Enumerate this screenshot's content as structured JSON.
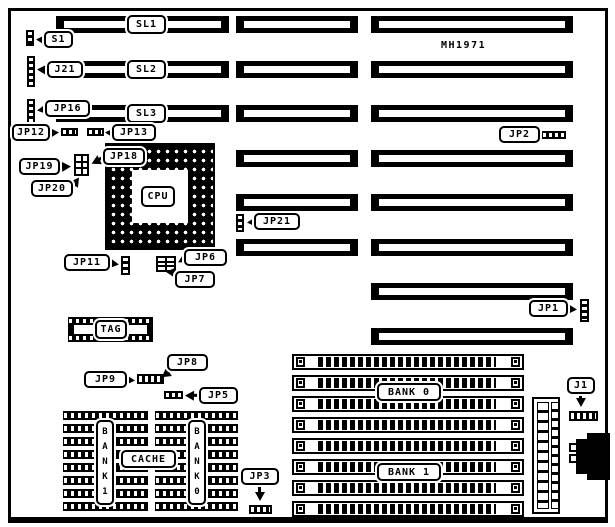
{
  "title": {
    "part_number": "MH1971"
  },
  "slots": [
    "SL1",
    "SL2",
    "SL3"
  ],
  "chips": {
    "cpu": "CPU",
    "tag": "TAG",
    "cache": "CACHE"
  },
  "banks": {
    "cache_left_vertical": "BANK 1",
    "cache_right_vertical": "BANK 0",
    "simm_top": "BANK 0",
    "simm_bottom": "BANK 1"
  },
  "callouts": {
    "s1": "S1",
    "j21": "J21",
    "jp16": "JP16",
    "jp12": "JP12",
    "jp13": "JP13",
    "jp18": "JP18",
    "jp19": "JP19",
    "jp20": "JP20",
    "jp2": "JP2",
    "jp21": "JP21",
    "jp11": "JP11",
    "jp6": "JP6",
    "jp7": "JP7",
    "jp1": "JP1",
    "jp9": "JP9",
    "jp8": "JP8",
    "jp5": "JP5",
    "jp3": "JP3",
    "j1": "J1"
  },
  "colors": {
    "ink": "#000000",
    "paper": "#ffffff"
  }
}
